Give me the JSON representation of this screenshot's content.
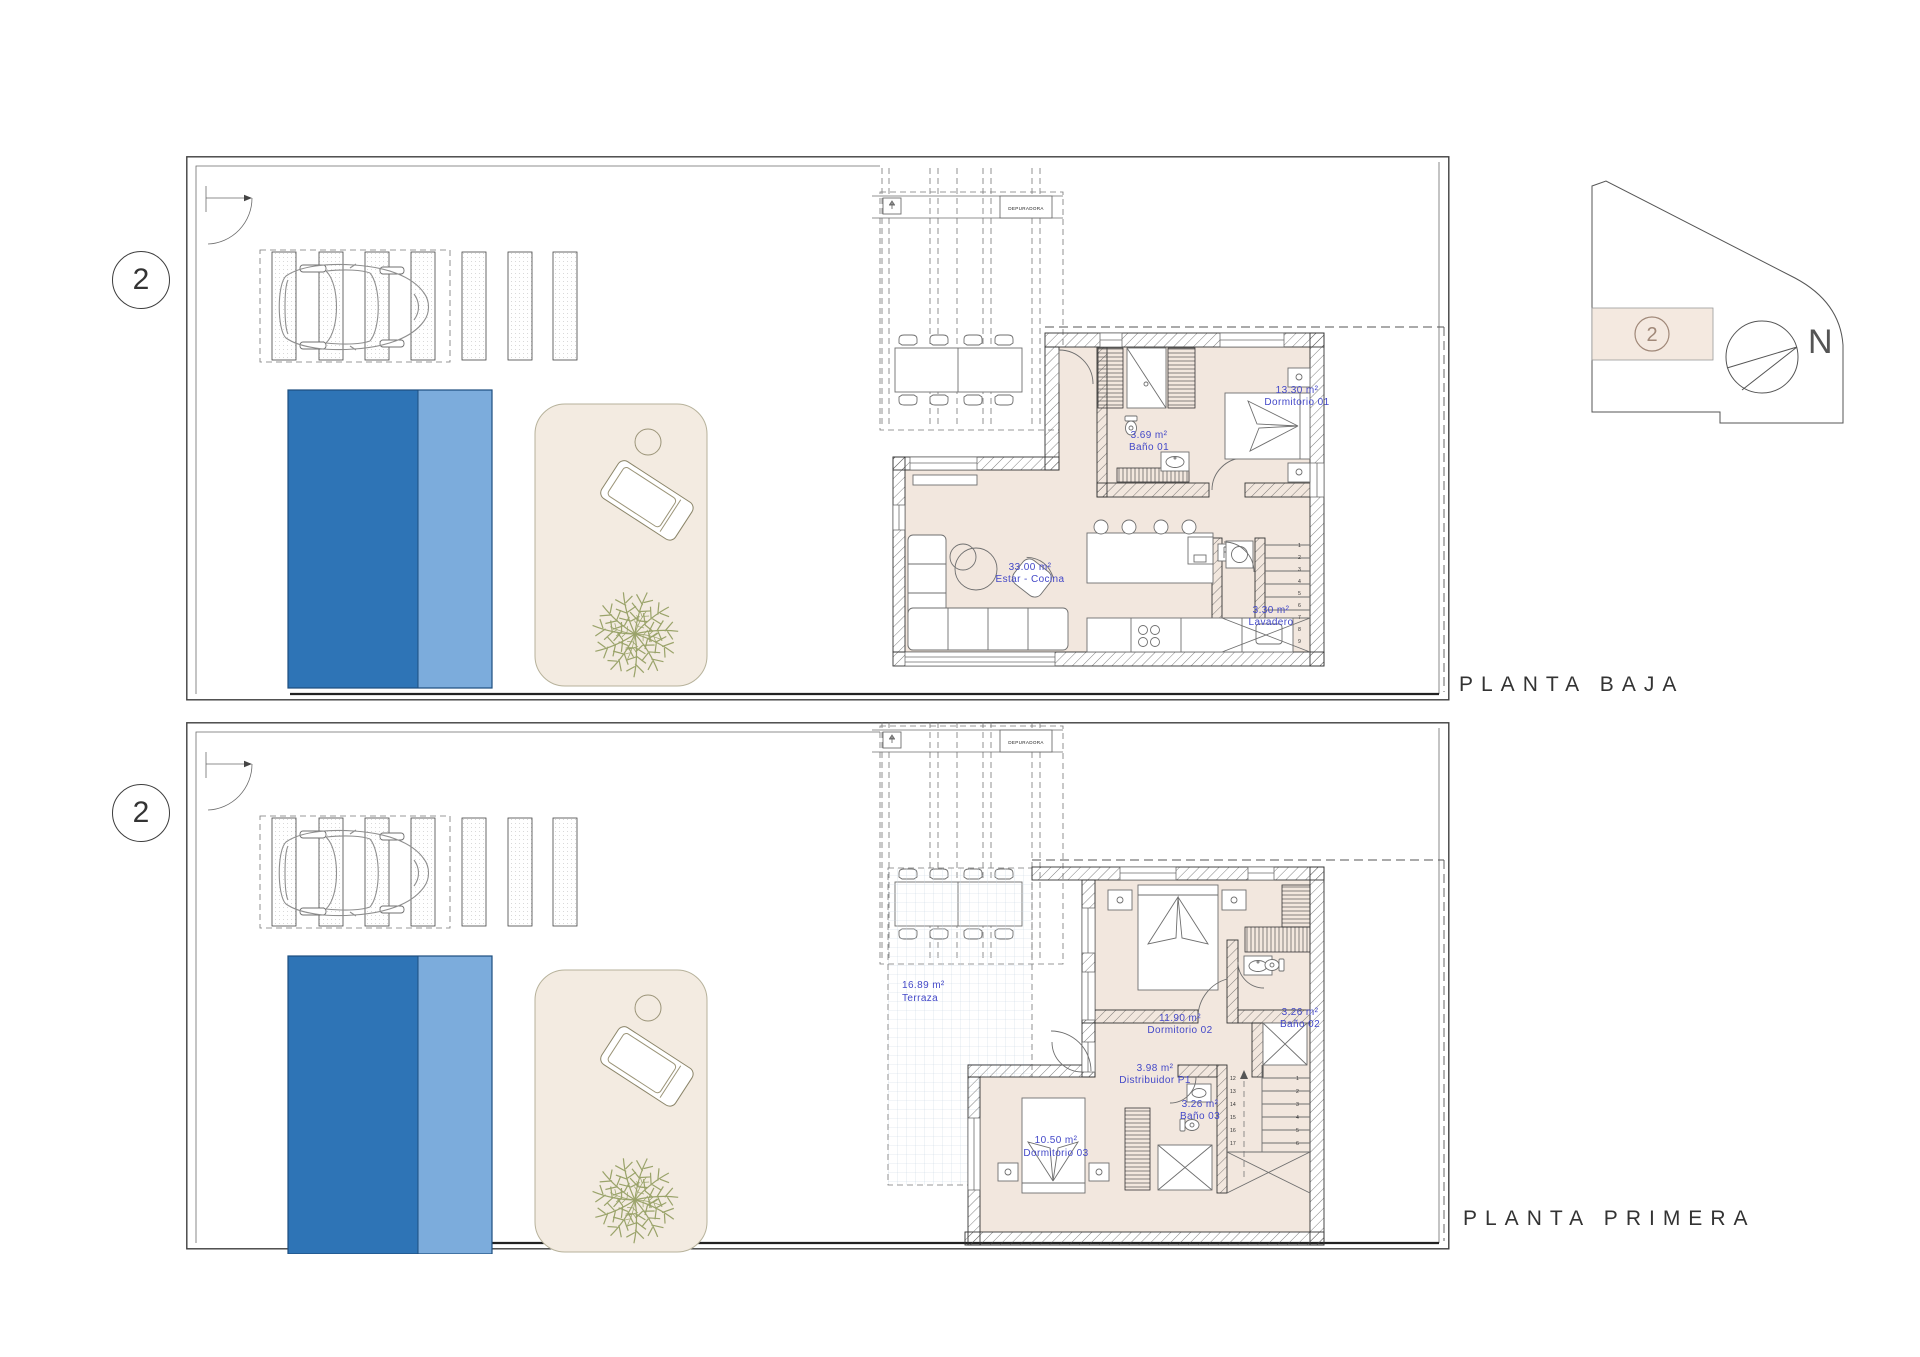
{
  "sheet": {
    "description_labels": {
      "planta_baja_title": "PLANTA BAJA",
      "planta_primera_title": "PLANTA PRIMERA"
    },
    "colors": {
      "pool_dark": "#2e74b6",
      "pool_light": "#7cacdc",
      "terrace_sand": "#f3ebe1",
      "interior_floor": "#f2e7de",
      "room_label_blue": "#4348c8",
      "plant_green": "#9aa36a",
      "line_dark": "#333333"
    }
  },
  "plans": [
    {
      "id": "planta-baja",
      "title": "PLANTA BAJA",
      "unit_number": "2",
      "equipment_label": "DEPURADORA",
      "rooms": [
        {
          "area": "33.00 m²",
          "name": "Estar - Cocina"
        },
        {
          "area": "3.69 m²",
          "name": "Baño 01"
        },
        {
          "area": "13.30 m²",
          "name": "Dormitorio 01"
        },
        {
          "area": "3.30 m²",
          "name": "Lavadero"
        }
      ]
    },
    {
      "id": "planta-primera",
      "title": "PLANTA PRIMERA",
      "unit_number": "2",
      "equipment_label": "DEPURADORA",
      "rooms": [
        {
          "area": "16.89 m²",
          "name": "Terraza"
        },
        {
          "area": "11.90 m²",
          "name": "Dormitorio 02"
        },
        {
          "area": "3.26 m²",
          "name": "Baño 02"
        },
        {
          "area": "3.98 m²",
          "name": "Distribuidor P1"
        },
        {
          "area": "3.26 m²",
          "name": "Baño 03"
        },
        {
          "area": "10.50 m²",
          "name": "Dormitorio 03"
        }
      ]
    }
  ],
  "stairs": {
    "baja": [
      "1",
      "2",
      "3",
      "4",
      "5",
      "6",
      "7",
      "8",
      "9"
    ],
    "primera_right": [
      "1",
      "2",
      "3",
      "4",
      "5",
      "6"
    ],
    "primera_left": [
      "12",
      "13",
      "14",
      "15",
      "16",
      "17"
    ]
  },
  "key_plan": {
    "unit_number": "2",
    "north_label": "N"
  }
}
